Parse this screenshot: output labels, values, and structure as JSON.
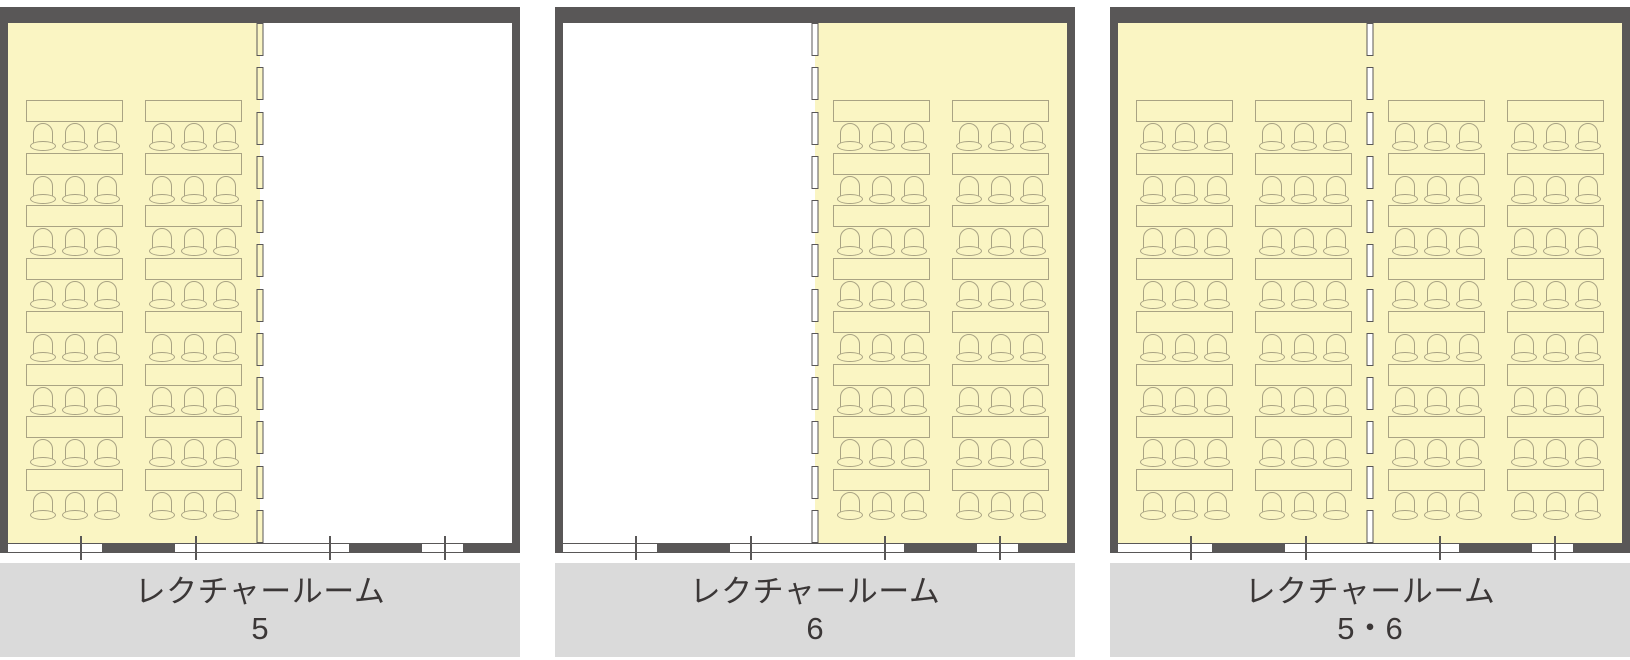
{
  "title": "レクチャールーム 平面図",
  "panels": [
    {
      "name": "レクチャールーム",
      "number": "5",
      "highlight": "left"
    },
    {
      "name": "レクチャールーム",
      "number": "6",
      "highlight": "right"
    },
    {
      "name": "レクチャールーム",
      "number": "5・6",
      "highlight": "both"
    }
  ],
  "layout_counts": {
    "desk_rows": 8,
    "desk_columns_per_half": 2,
    "chairs_per_desk": 3,
    "partition_segments": 12
  },
  "colors": {
    "wall": "#595757",
    "room_highlight": "#faf5c3",
    "furniture_outline": "#a9a383",
    "label_bar_bg": "#dadada",
    "label_text": "#3b3737",
    "white": "#ffffff"
  }
}
